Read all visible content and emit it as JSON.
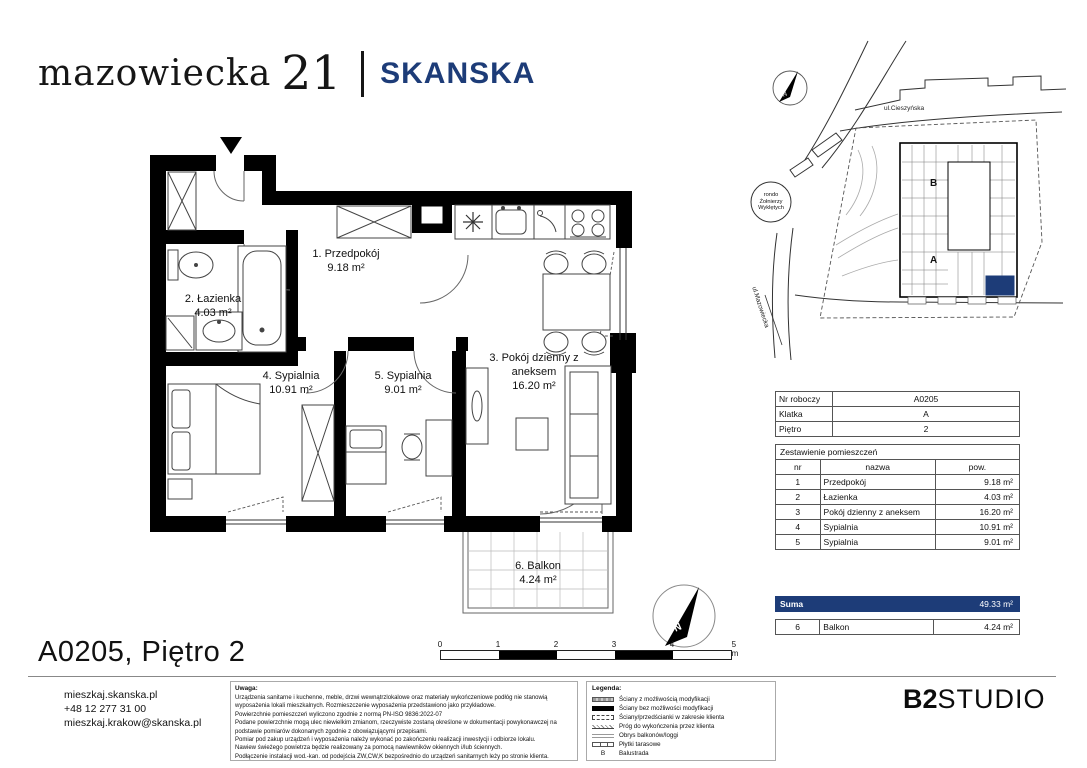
{
  "header": {
    "logo_name": "mazowiecka",
    "logo_number": "21",
    "brand": "SKANSKA"
  },
  "plan": {
    "rooms": [
      {
        "name": "1. Przedpokój",
        "area": "9.18 m²"
      },
      {
        "name": "2. Łazienka",
        "area": "4.03 m²"
      },
      {
        "name": "3. Pokój dzienny z aneksem",
        "area": "16.20 m²"
      },
      {
        "name": "4. Sypialnia",
        "area": "10.91 m²"
      },
      {
        "name": "5. Sypialnia",
        "area": "9.01 m²"
      },
      {
        "name": "6. Balkon",
        "area": "4.24 m²"
      }
    ]
  },
  "site_plan": {
    "street_top": "ul.Cieszyńska",
    "street_left": "ul.Mazowiecka",
    "roundabout_line1": "rondo",
    "roundabout_line2": "Żołnierzy",
    "roundabout_line3": "Wyklętych",
    "stair_b": "B",
    "stair_a": "A",
    "compass": "N"
  },
  "info_table": {
    "rows": [
      [
        "Nr roboczy",
        "A0205"
      ],
      [
        "Klatka",
        "A"
      ],
      [
        "Piętro",
        "2"
      ]
    ]
  },
  "rooms_table": {
    "title": "Zestawienie pomieszczeń",
    "columns": [
      "nr",
      "nazwa",
      "pow."
    ],
    "rows": [
      [
        "1",
        "Przedpokój",
        "9.18 m²"
      ],
      [
        "2",
        "Łazienka",
        "4.03 m²"
      ],
      [
        "3",
        "Pokój dzienny z aneksem",
        "16.20 m²"
      ],
      [
        "4",
        "Sypialnia",
        "10.91 m²"
      ],
      [
        "5",
        "Sypialnia",
        "9.01 m²"
      ]
    ],
    "suma_label": "Suma",
    "suma_value": "49.33 m²",
    "balcony_row": [
      "6",
      "Balkon",
      "4.24 m²"
    ]
  },
  "scale_bar": {
    "ticks": [
      "0",
      "1",
      "2",
      "3",
      "4",
      "5 m"
    ]
  },
  "footer": {
    "apartment_title": "A0205, Piętro 2",
    "contact_lines": [
      "mieszkaj.skanska.pl",
      "+48 12 277 31 00",
      "mieszkaj.krakow@skanska.pl"
    ],
    "notes_title": "Uwaga:",
    "notes": [
      "Urządzenia sanitarne i kuchenne, meble, drzwi wewnątrzlokalowe oraz materiały wykończeniowe podłóg nie stanowią wyposażenia lokali mieszkalnych. Rozmieszczenie wyposażenia przedstawiono jako przykładowe.",
      "Powierzchnie pomieszczeń wyliczono zgodnie z normą PN-ISO 9836:2022-07",
      "Podane powierzchnie mogą ulec niewielkim zmianom, rzeczywiste zostaną określone w dokumentacji powykonawczej na podstawie pomiarów dokonanych zgodnie z obowiązującymi przepisami.",
      "Pomiar pod zakup urządzeń i wyposażenia należy wykonać po zakończeniu realizacji inwestycji i odbiorze lokalu.",
      "Nawiew świeżego powietrza będzie realizowany za pomocą nawiewników okiennych i/lub ściennych.",
      "Podłączenie instalacji wod.-kan. od podejścia ZW,CW,K bezpośrednio do urządzeń sanitarnych leży po stronie klienta."
    ],
    "legend_title": "Legenda:",
    "legend": [
      {
        "label": "Ściany z możliwością modyfikacji"
      },
      {
        "label": "Ściany bez możliwości modyfikacji"
      },
      {
        "label": "Ściany/przedścianki w zakresie klienta"
      },
      {
        "label": "Próg do wykończenia przez klienta"
      },
      {
        "label": "Obrys balkonów/loggi"
      },
      {
        "label": "Płytki tarasowe"
      },
      {
        "prefix": "B",
        "label": "Balustrada"
      }
    ],
    "studio_bold": "B2",
    "studio_light": "STUDIO"
  },
  "colors": {
    "navy": "#1d3c78",
    "wall_black": "#000000"
  }
}
